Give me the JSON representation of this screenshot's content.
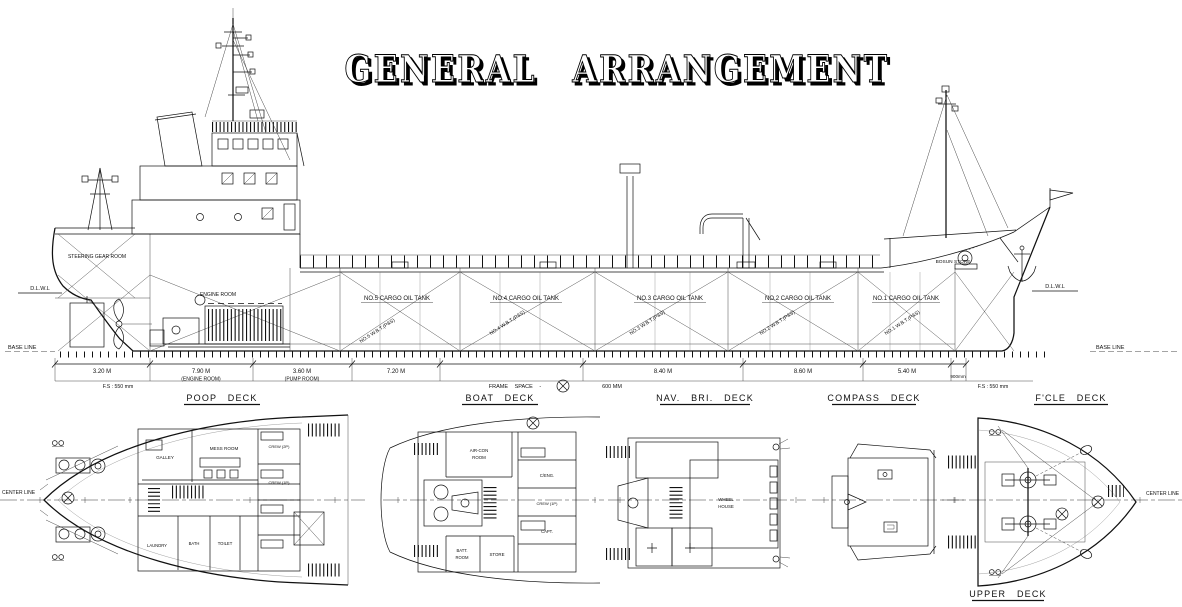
{
  "title": "GENERAL ARRANGEMENT",
  "profile": {
    "steering_gear_room": "STEERING GEAR ROOM",
    "engine_room": "ENGINE ROOM",
    "bosun_store": "BOSUN STORE",
    "dlwl": "D.L.W.L",
    "base_line": "BASE LINE",
    "tanks": [
      {
        "name": "NO.5 CARGO OIL TANK",
        "wbt": "NO.5 W.B.T.(P&S)"
      },
      {
        "name": "NO.4 CARGO OIL TANK",
        "wbt": "NO.4 W.B.T.(P&S)"
      },
      {
        "name": "NO.3 CARGO OIL TANK",
        "wbt": "NO.3 W.B.T.(P&S)"
      },
      {
        "name": "NO.2 CARGO OIL TANK",
        "wbt": "NO.2 W.B.T.(P&S)"
      },
      {
        "name": "NO.1 CARGO OIL TANK",
        "wbt": "NO.1 W.B.T.(P&S)"
      }
    ],
    "dims": {
      "seg1": "3.20 M",
      "seg2": "7.90 M",
      "seg2_note": "(ENGINE ROOM)",
      "seg3": "3.60 M",
      "seg3_note": "(PUMP ROOM)",
      "seg4": "7.20 M",
      "seg5": "8.40 M",
      "seg6": "8.60 M",
      "seg7": "5.40 M",
      "seg8": "900mm",
      "fs": "F.S : 550 mm",
      "frame_space": "FRAME SPACE -",
      "frame_space_value": "600 MM"
    }
  },
  "plans": {
    "center_line": "CENTER LINE",
    "poop": {
      "label": "POOP DECK",
      "galley": "GALLEY",
      "mess_room": "MESS ROOM",
      "laundry": "LAUNDRY",
      "bath": "BATH",
      "toilet": "TOILET",
      "crew_2p": "CREW (2P)",
      "crew_1p": "CREW (1P)"
    },
    "boat": {
      "label": "BOAT DECK",
      "aircon_1": "AIR-CON",
      "aircon_2": "ROOM",
      "batt_1": "BATT.",
      "batt_2": "ROOM",
      "store": "STORE",
      "c_eng": "C/ENG.",
      "crew_1p": "CREW (1P)",
      "capt": "CAPT."
    },
    "nav": {
      "label": "NAV. BRI. DECK",
      "wheel_1": "WHEEL",
      "wheel_2": "HOUSE"
    },
    "compass": {
      "label": "COMPASS DECK"
    },
    "fcle": {
      "label": "F'CLE DECK"
    },
    "upper": {
      "label": "UPPER DECK"
    }
  }
}
